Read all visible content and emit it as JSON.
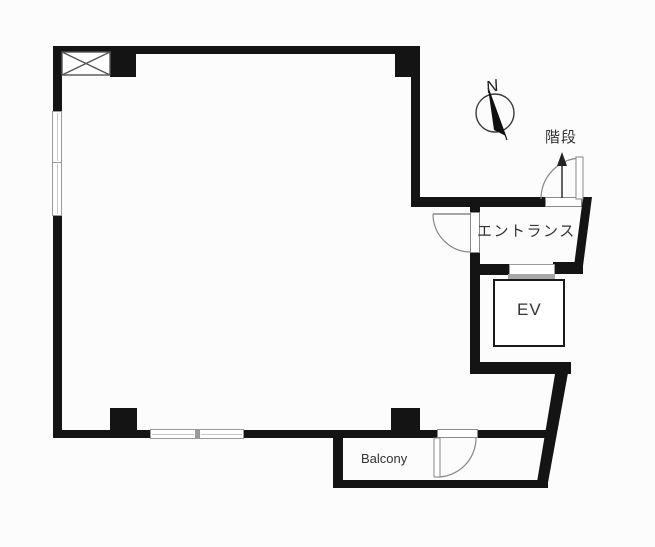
{
  "plan": {
    "compass_north": "N",
    "rooms": {
      "stairs_label": "階段",
      "entrance_label": "エントランス",
      "elevator_label": "EV",
      "balcony_label": "Balcony"
    },
    "colors": {
      "wall": "#141414",
      "thin_line": "#888888",
      "window_frame": "#9a9a9a",
      "text": "#333333",
      "background": "#fcfcfc"
    }
  }
}
